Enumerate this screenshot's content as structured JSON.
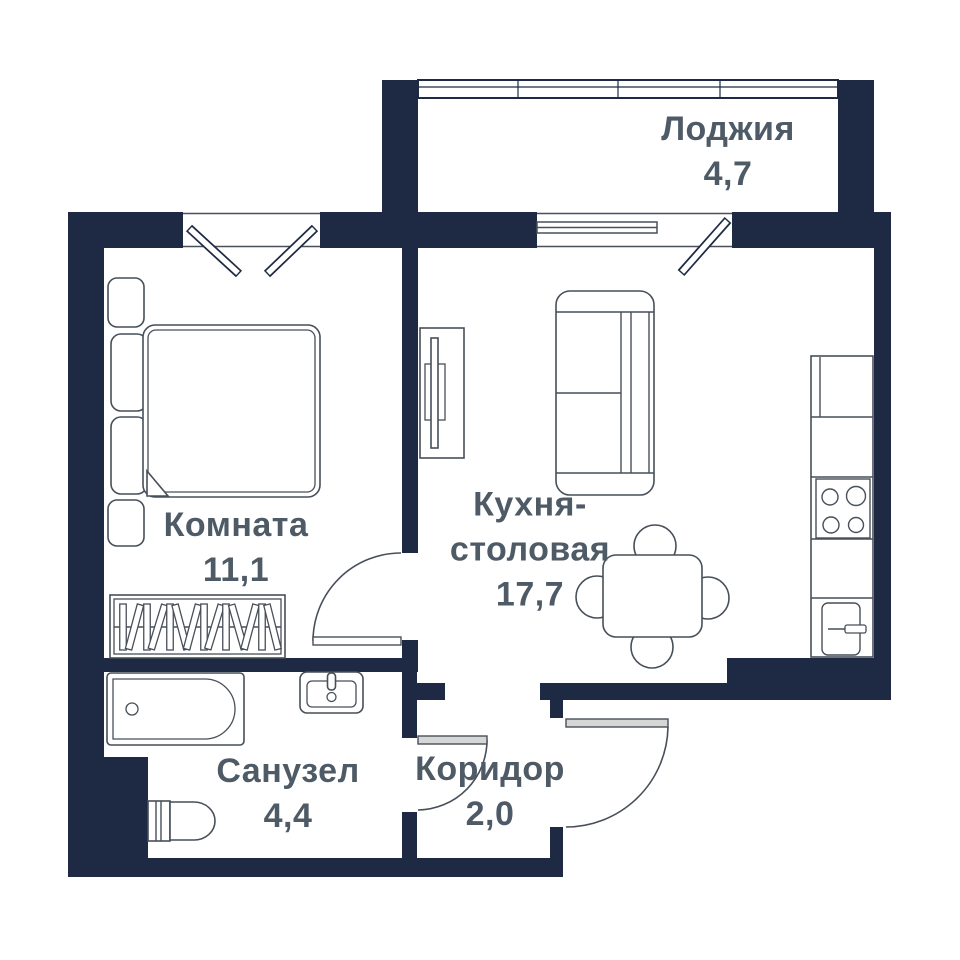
{
  "colors": {
    "wall": "#1e2a44",
    "label": "#4e5b66",
    "line": "#474f59",
    "frame": "#49505a",
    "door-leaf": "#d6d6d6",
    "bg": "#ffffff"
  },
  "rooms": {
    "loggia": {
      "name": "Лоджия",
      "area": "4,7"
    },
    "room": {
      "name": "Комната",
      "area": "11,1"
    },
    "kitchen": {
      "name_line1": "Кухня-",
      "name_line2": "столовая",
      "area": "17,7"
    },
    "bathroom": {
      "name": "Санузел",
      "area": "4,4"
    },
    "corridor": {
      "name": "Коридор",
      "area": "2,0"
    }
  }
}
